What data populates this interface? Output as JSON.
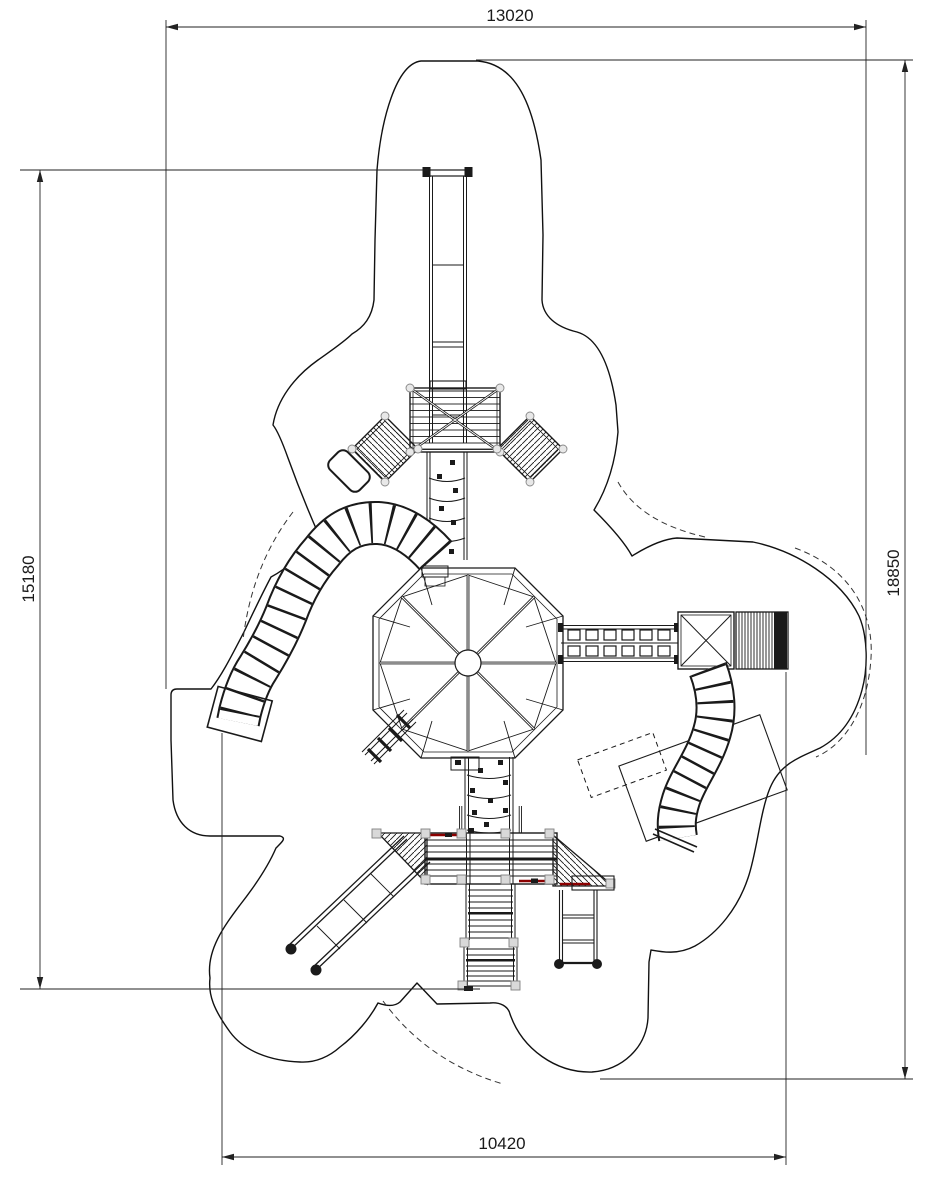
{
  "drawing": {
    "kind": "playground-equipment-plan-view",
    "dimensions": {
      "top_width": "13020",
      "left_height": "15180",
      "right_height": "18850",
      "bottom_width": "10420"
    },
    "colors": {
      "line": "#1a1a1a",
      "dimension_line": "#222222",
      "accent_red": "#8b0000",
      "post_fill": "#d9d9d9",
      "post_stroke": "#808080"
    }
  }
}
